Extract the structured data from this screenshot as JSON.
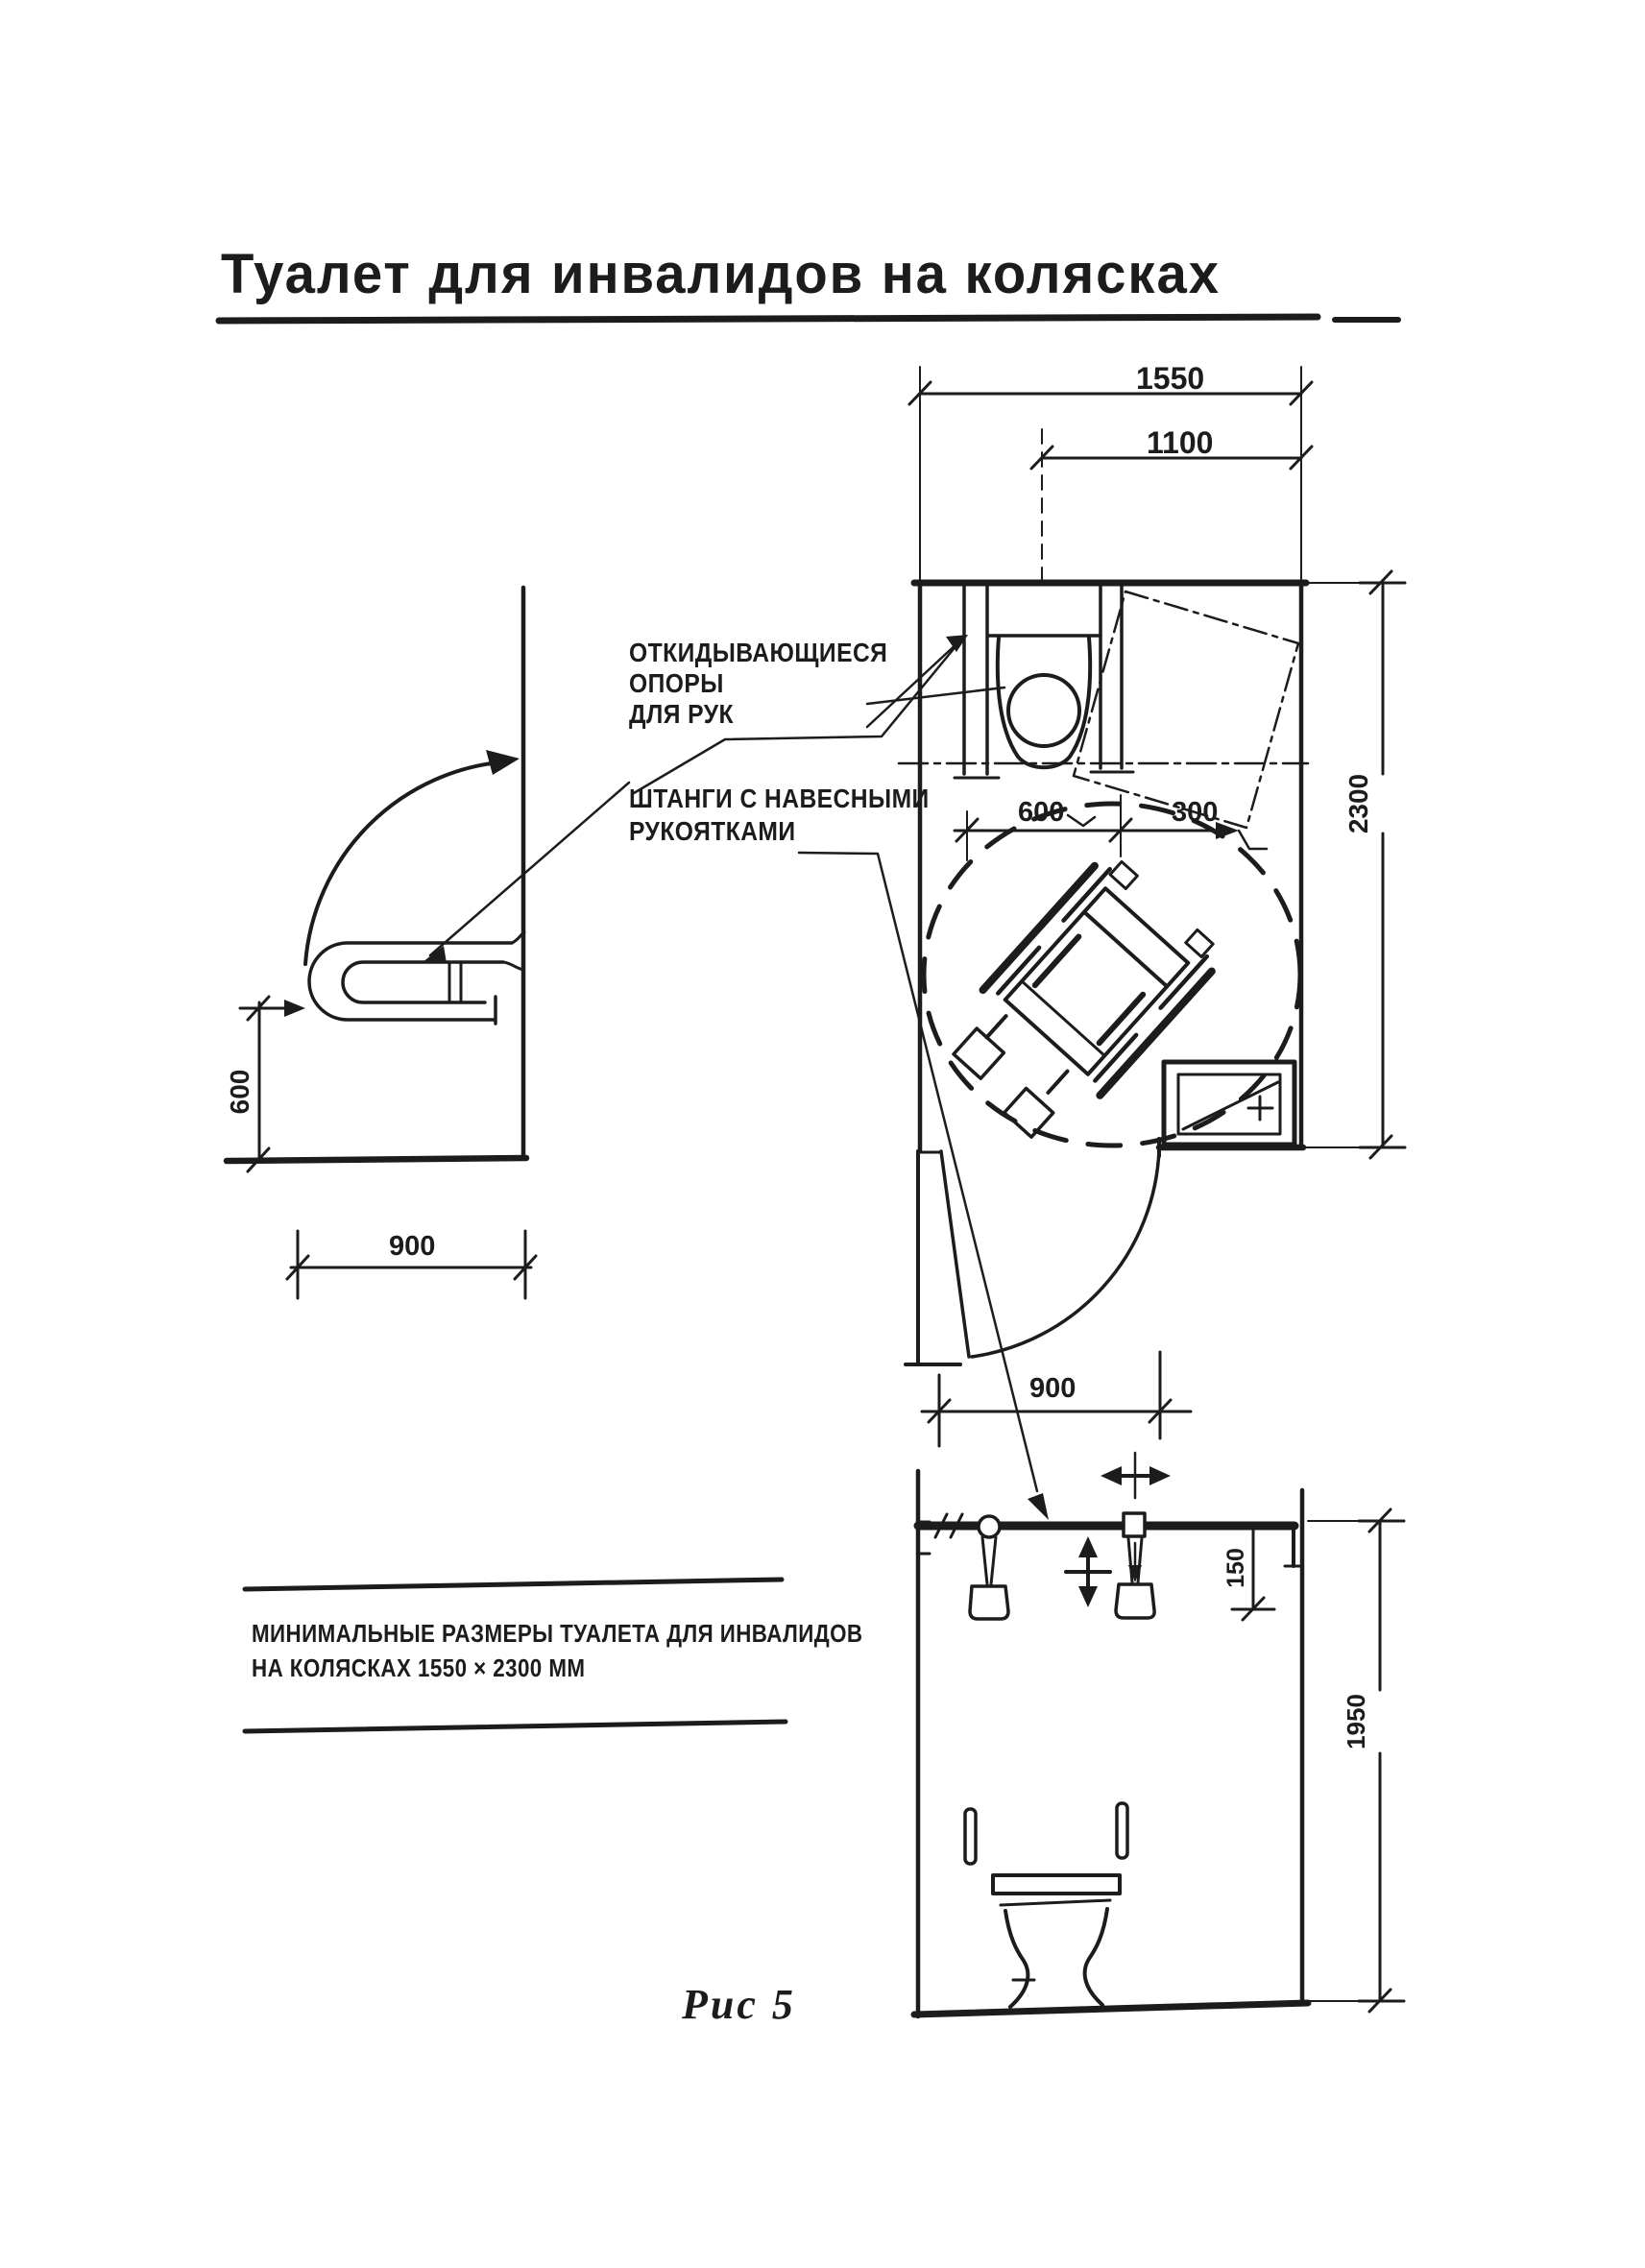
{
  "title": "Туалет для инвалидов на колясках",
  "figure_caption": "Рис 5",
  "note": {
    "line1": "МИНИМАЛЬНЫЕ РАЗМЕРЫ ТУАЛЕТА ДЛЯ ИНВАЛИДОВ",
    "line2": "НА КОЛЯСКАХ  1550 × 2300  ММ"
  },
  "annotations": {
    "folding_supports_line1": "ОТКИДЫВАЮЩИЕСЯ",
    "folding_supports_line2": "ОПОРЫ",
    "folding_supports_line3": "ДЛЯ РУК",
    "hanging_rods_line1": "ШТАНГИ С НАВЕСНЫМИ",
    "hanging_rods_line2": "РУКОЯТКАМИ"
  },
  "dimensions": {
    "room_width": "1550",
    "door_clearance": "1100",
    "room_depth": "2300",
    "toilet_axis_offset": "600",
    "basin_offset": "300",
    "support_height": "600",
    "support_length": "900",
    "door_width": "900",
    "handle_drop": "150",
    "rod_height": "1950"
  },
  "colors": {
    "ink": "#1c1c1c",
    "paper": "#ffffff"
  }
}
